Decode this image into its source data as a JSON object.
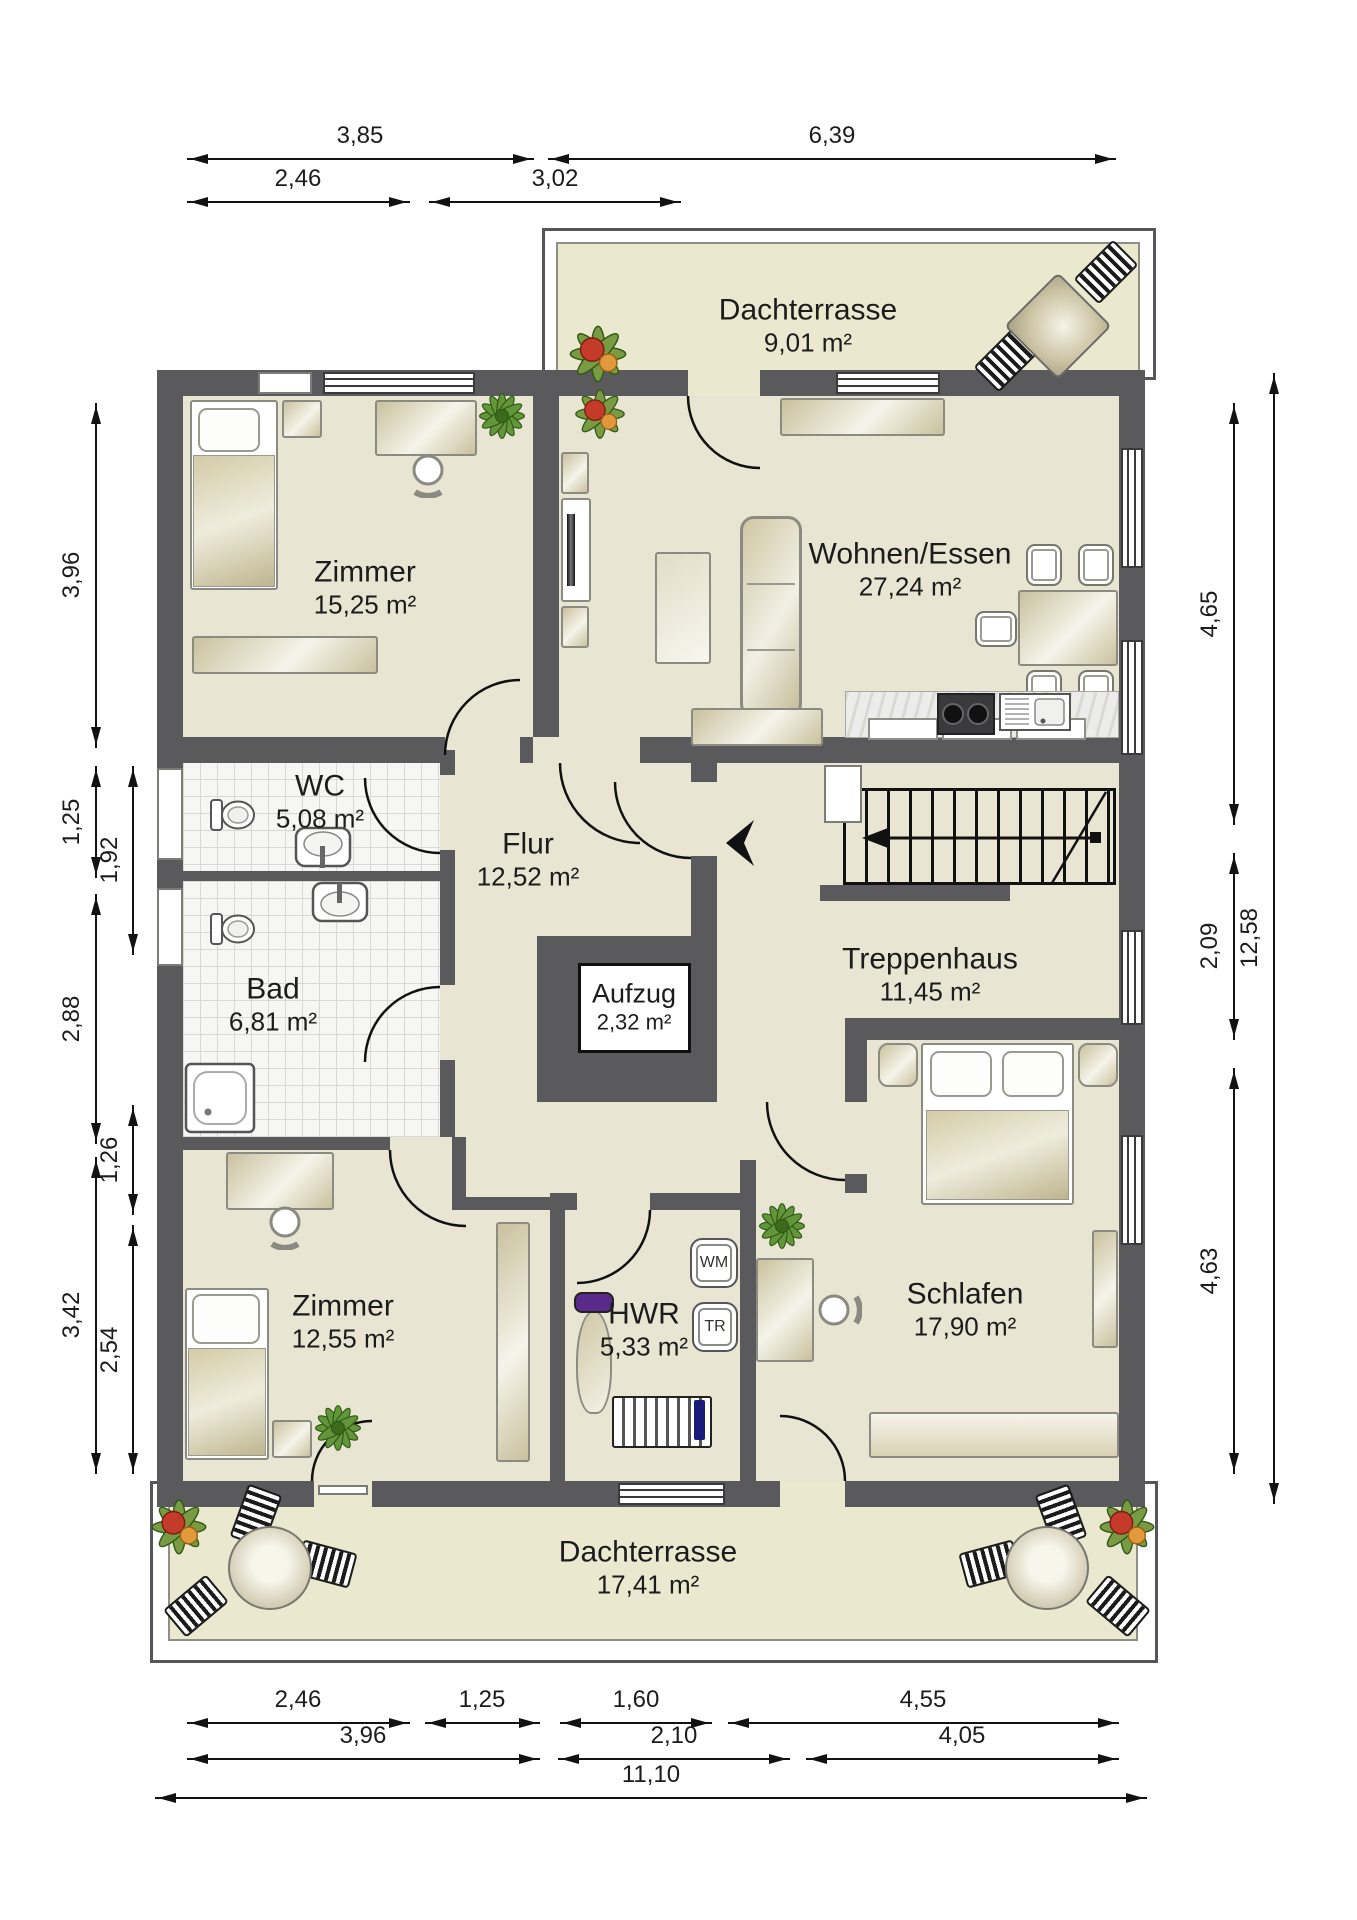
{
  "rooms": [
    {
      "id": "dachterrasse-top",
      "name": "Dachterrasse",
      "area": "9,01 m²"
    },
    {
      "id": "zimmer-nw",
      "name": "Zimmer",
      "area": "15,25 m²"
    },
    {
      "id": "wohnen-essen",
      "name": "Wohnen/Essen",
      "area": "27,24 m²"
    },
    {
      "id": "wc",
      "name": "WC",
      "area": "5,08 m²"
    },
    {
      "id": "flur",
      "name": "Flur",
      "area": "12,52 m²"
    },
    {
      "id": "bad",
      "name": "Bad",
      "area": "6,81 m²"
    },
    {
      "id": "aufzug",
      "name": "Aufzug",
      "area": "2,32 m²"
    },
    {
      "id": "treppenhaus",
      "name": "Treppenhaus",
      "area": "11,45 m²"
    },
    {
      "id": "zimmer-sw",
      "name": "Zimmer",
      "area": "12,55 m²"
    },
    {
      "id": "hwr",
      "name": "HWR",
      "area": "5,33 m²"
    },
    {
      "id": "schlafen",
      "name": "Schlafen",
      "area": "17,90 m²"
    },
    {
      "id": "dachterrasse-bottom",
      "name": "Dachterrasse",
      "area": "17,41 m²"
    }
  ],
  "appliances": {
    "washer": "WM",
    "dryer": "TR"
  },
  "dimensions": {
    "top_row1": [
      "3,85",
      "6,39"
    ],
    "top_row2": [
      "2,46",
      "3,02"
    ],
    "left_outer": [
      "3,96",
      "1,25",
      "2,88",
      "3,42"
    ],
    "left_inner": [
      "1,92",
      "1,26",
      "2,54"
    ],
    "right_inner": [
      "4,65",
      "2,09",
      "4,63"
    ],
    "right_outer": [
      "12,58"
    ],
    "bottom_row1": [
      "2,46",
      "1,25",
      "1,60",
      "4,55"
    ],
    "bottom_row2": [
      "3,96",
      "2,10",
      "4,05"
    ],
    "bottom_row3": [
      "11,10"
    ]
  },
  "colors": {
    "wall": "#5a5a5c",
    "floor": "#e9e5d3",
    "terrace": "#ebe8d0",
    "tile": "#f6f6f4",
    "furniture": "#d8d1b2",
    "plant": "#63953a",
    "dimension": "#121212"
  }
}
